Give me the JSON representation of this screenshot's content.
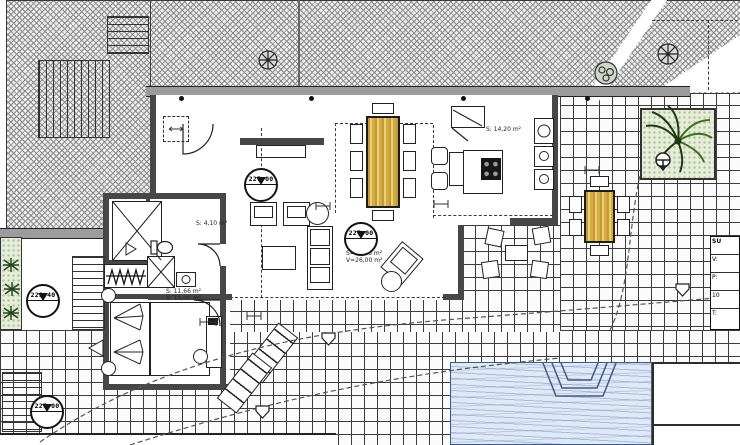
{
  "plan": {
    "markers": {
      "entry_level": "227.00",
      "living_level": "227.00",
      "upper_terrace_level": "229.40",
      "lower_terrace_level": "227.00"
    },
    "areas": {
      "kitchen": "S: 14,20 m²",
      "living_s": "S=41,35 m²",
      "living_v": "V=26,00 m²",
      "bedroom_s": "S: 11,66 m²",
      "bedroom_v": "V: 10,00 m²",
      "bath": "S: 4,10 m²"
    },
    "legend_rows": [
      "SU",
      "V:",
      "P:",
      "10",
      "T:"
    ],
    "colors": {
      "wall": "#474747",
      "wood_furniture": "#cfa63b",
      "pool_water": "#dfe9f6",
      "plant_green": "#2f5a1e",
      "planter_bg": "#e6edda",
      "tile_line": "#3c3c3c"
    }
  }
}
